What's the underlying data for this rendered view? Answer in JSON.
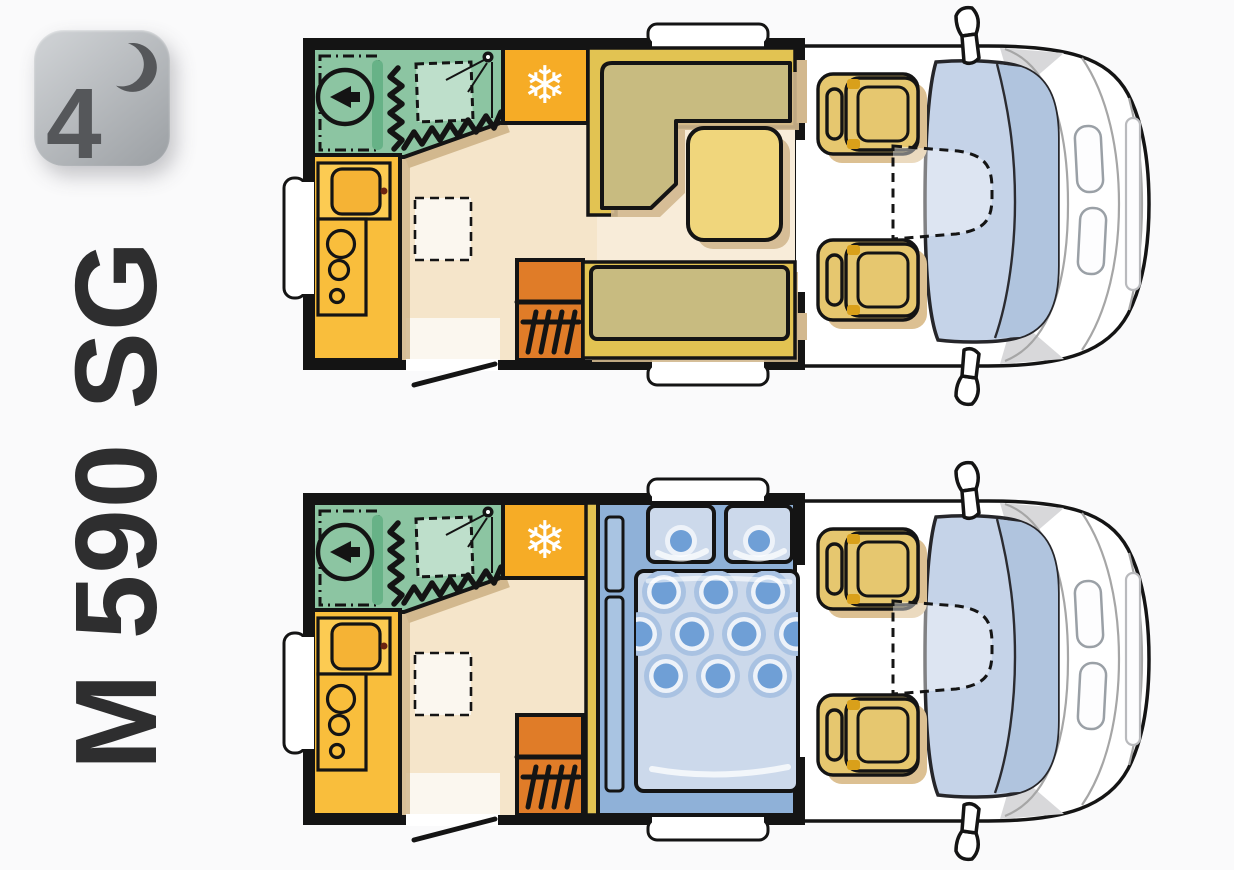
{
  "badge": {
    "value": "4",
    "icon": "crescent-moon"
  },
  "model": {
    "name": "M 590 SG"
  },
  "icons": {
    "snowflake": "❄"
  },
  "colors": {
    "page-bg": "#fafafb",
    "ink": "#141414",
    "model-text": "#2e2e2f",
    "badge-from": "#cccfd2",
    "badge-to": "#9ea2a6",
    "badge-glyph": "#55575a",
    "floor": "#f5e5ca",
    "floor-light": "#f8ecd9",
    "floor-white": "#fbf7ef",
    "shadow-tan": "#d2b88e",
    "bathroom-green": "#8cc5a2",
    "bathroom-light": "#bedfcb",
    "bathroom-bar": "#67b287",
    "fridge-orange": "#f6ac26",
    "heater-orange": "#e07c28",
    "kitchen-yellow": "#f9be3c",
    "kitchen-sink-block": "#fccb52",
    "kitchen-sink": "#f5b335",
    "bench-yellow": "#e2c352",
    "cushion-olive": "#c8bb80",
    "table-gold": "#f0d67c",
    "seat-tan": "#e6c76f",
    "seat-accent": "#d9a01a",
    "seat-shadow": "#dcc092",
    "windshield": "#c5d3e8",
    "windshield-dark": "#b0c4de",
    "bed-platform": "#8fb1d8",
    "bed-panel": "#a9c4e2",
    "duvet": "#ccd9eb",
    "duvet-ring": "#a9c2e2",
    "duvet-dot": "#6f9fd6",
    "pillow": "#ccd9eb",
    "body-line": "#a6a6a6",
    "body-grey": "#d8d8da"
  }
}
